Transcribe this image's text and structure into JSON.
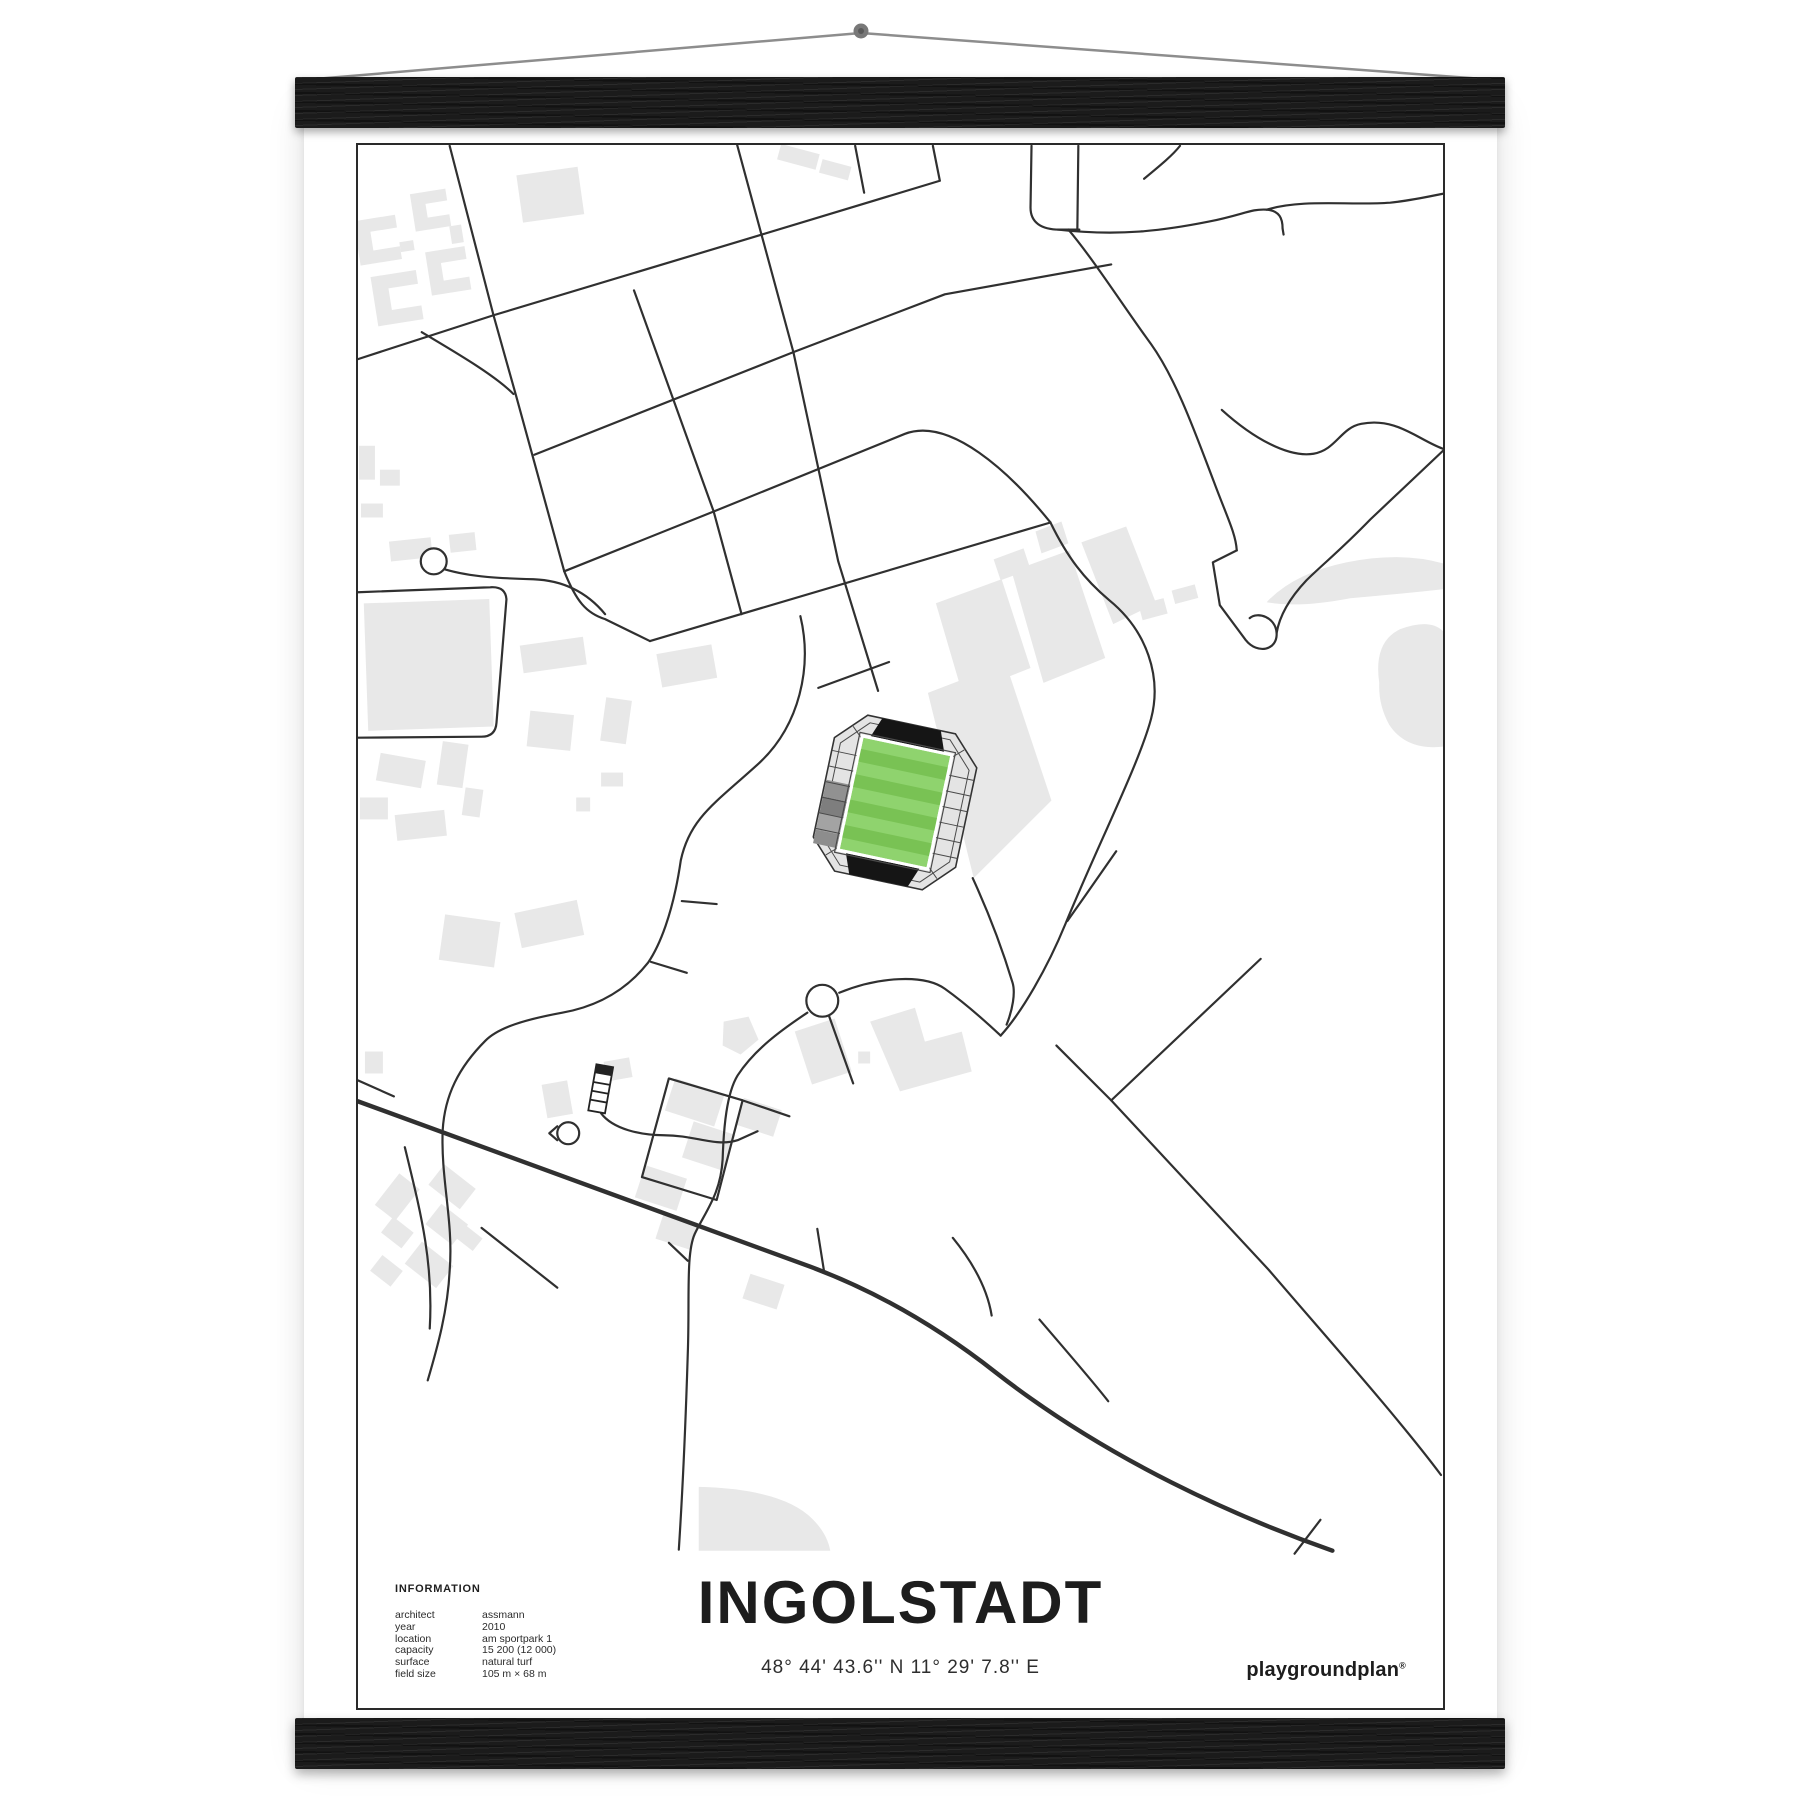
{
  "poster": {
    "title": "INGOLSTADT",
    "coordinates": "48° 44' 43.6'' N  11° 29' 7.8'' E",
    "brand": "playgroundplan",
    "brand_mark": "®",
    "info": {
      "heading": "INFORMATION",
      "rows": [
        {
          "label": "architect",
          "value": "assmann"
        },
        {
          "label": "year",
          "value": "2010"
        },
        {
          "label": "location",
          "value": "am sportpark 1"
        },
        {
          "label": "capacity",
          "value": "15 200 (12 000)"
        },
        {
          "label": "surface",
          "value": "natural turf"
        },
        {
          "label": "field size",
          "value": "105 m × 68 m"
        }
      ]
    }
  },
  "colors": {
    "road": "#303030",
    "building": "#e8e8e8",
    "pitch_light": "#8fd36e",
    "pitch_dark": "#79c254",
    "stand_black": "#151515",
    "ring_gray": "#e4e4e4",
    "frame": "#2a2a2a",
    "string": "#8d8d8d"
  }
}
